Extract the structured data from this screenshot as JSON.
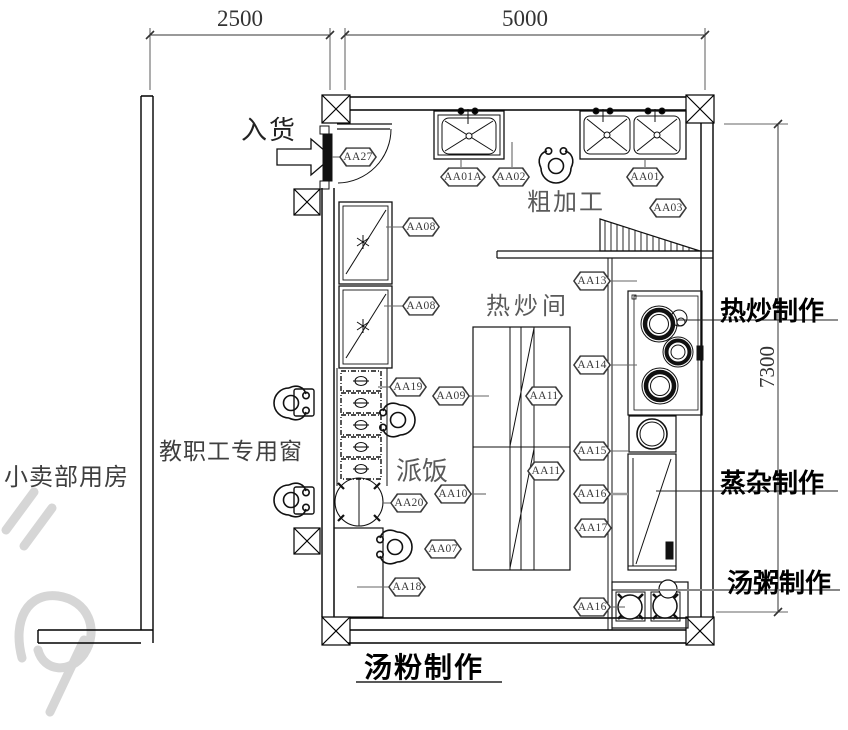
{
  "title": "kitchen-floor-plan",
  "dimensions": {
    "width_left": "2500",
    "width_main": "5000",
    "height_main": "7300"
  },
  "labels": {
    "incoming_goods": "入货",
    "rough_processing": "粗加工",
    "hot_fry_room": "热炒间",
    "serve_rice": "派饭",
    "staff_window": "教职工专用窗",
    "shop_room": "小卖部用房",
    "hot_fry_production": "热炒制作",
    "steam_production": "蒸杂制作",
    "porridge_production": "汤粥制作",
    "noodle_soup_production": "汤粉制作"
  },
  "tags": [
    {
      "label": "AA27",
      "x": 339,
      "y": 147
    },
    {
      "label": "AA01A",
      "x": 440,
      "y": 167
    },
    {
      "label": "AA02",
      "x": 492,
      "y": 167
    },
    {
      "label": "AA01",
      "x": 626,
      "y": 167
    },
    {
      "label": "AA03",
      "x": 649,
      "y": 198
    },
    {
      "label": "AA08",
      "x": 402,
      "y": 217
    },
    {
      "label": "AA08",
      "x": 402,
      "y": 296
    },
    {
      "label": "AA13",
      "x": 573,
      "y": 271
    },
    {
      "label": "AA14",
      "x": 573,
      "y": 355
    },
    {
      "label": "AA09",
      "x": 432,
      "y": 386
    },
    {
      "label": "AA11",
      "x": 525,
      "y": 386
    },
    {
      "label": "AA19",
      "x": 389,
      "y": 377
    },
    {
      "label": "AA10",
      "x": 434,
      "y": 484
    },
    {
      "label": "AA11",
      "x": 527,
      "y": 461
    },
    {
      "label": "AA20",
      "x": 390,
      "y": 493
    },
    {
      "label": "AA15",
      "x": 573,
      "y": 441
    },
    {
      "label": "AA16",
      "x": 573,
      "y": 484
    },
    {
      "label": "AA17",
      "x": 574,
      "y": 518
    },
    {
      "label": "AA07",
      "x": 424,
      "y": 539
    },
    {
      "label": "AA18",
      "x": 388,
      "y": 577
    },
    {
      "label": "AA16",
      "x": 573,
      "y": 597
    }
  ],
  "line_colors": {
    "wall": "#000000",
    "leader": "#666666",
    "dimension": "#333333",
    "watermark": "#d6d6d6"
  }
}
